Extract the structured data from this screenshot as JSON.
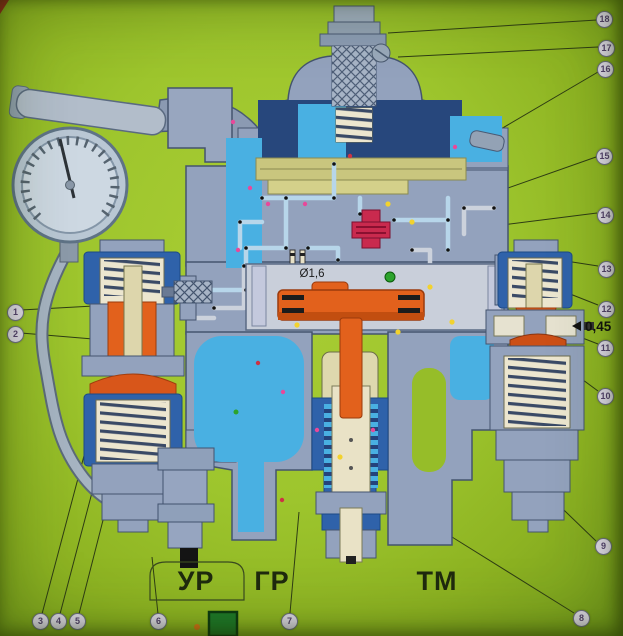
{
  "diagram": {
    "type": "cutaway-schematic",
    "subject": "pneumatic brake valve cross-section poster",
    "ports": {
      "ur": "УР",
      "gr": "ГР",
      "tm": "ТМ"
    },
    "annotations": {
      "orifice": "Ø1,6",
      "stabilizer_orifice": "0,45"
    },
    "callouts": [
      "1",
      "2",
      "3",
      "4",
      "5",
      "6",
      "7",
      "8",
      "9",
      "10",
      "11",
      "12",
      "13",
      "14",
      "15",
      "16",
      "17",
      "18"
    ],
    "colors": {
      "background": "#9dc52d",
      "body_casting": "#93a2bd",
      "body_outline": "#44546e",
      "chamber_cyan": "#49b0e2",
      "royal_blue": "#2f62aa",
      "navy_chamber": "#27477c",
      "olive_slide_valve": "#c9c67e",
      "orange_piston": "#e2611c",
      "dark_orange_diaphragm": "#cc4f16",
      "red_valve": "#c92a4e",
      "cream_spring": "#ece6cf",
      "callout_fill": "#ded9e8",
      "dot_pink": "#e8489a",
      "dot_yellow": "#f2d22e",
      "dot_green": "#2ca32c",
      "green_block": "#1d7a2a"
    }
  }
}
